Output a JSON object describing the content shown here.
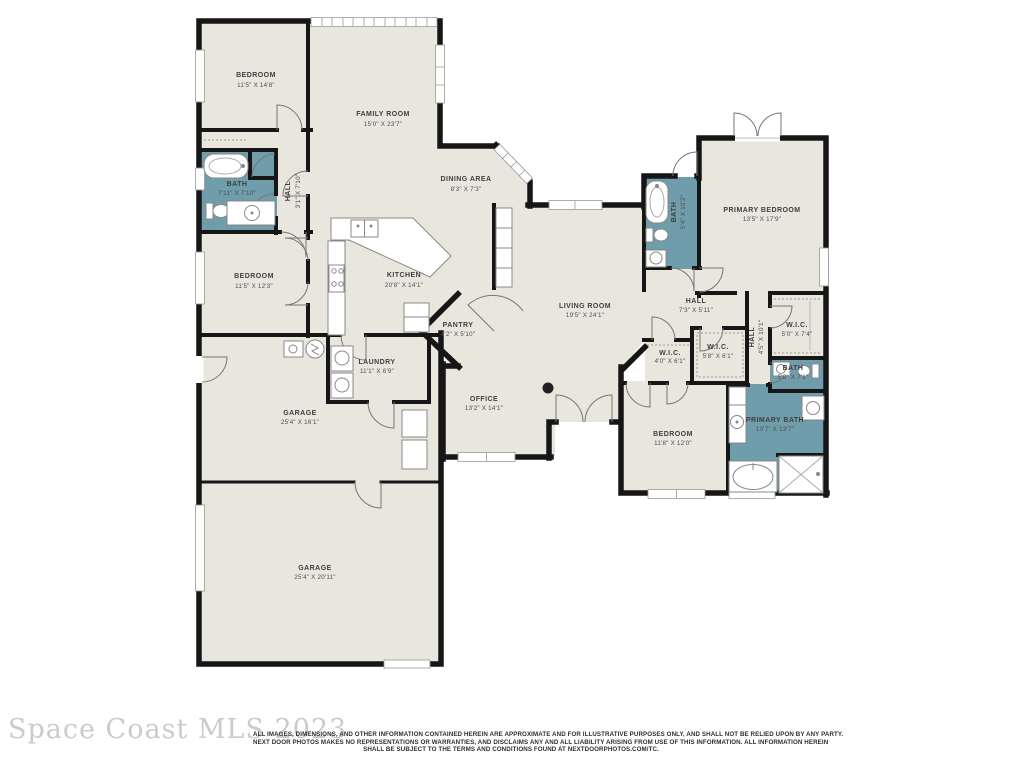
{
  "watermark": "Space Coast MLS 2023",
  "disclaimer": {
    "line1": "ALL IMAGES, DIMENSIONS, AND OTHER INFORMATION CONTAINED HEREIN ARE APPROXIMATE AND FOR ILLUSTRATIVE PURPOSES ONLY, AND SHALL NOT BE RELIED UPON BY ANY PARTY.",
    "line2": "NEXT DOOR PHOTOS MAKES NO REPRESENTATIONS OR WARRANTIES, AND DISCLAIMS ANY AND ALL LIABILITY ARISING FROM USE OF THIS INFORMATION. ALL INFORMATION HEREIN",
    "line3": "SHALL BE SUBJECT TO THE TERMS AND CONDITIONS FOUND AT NEXTDOORPHOTOS.COM/TC."
  },
  "colors": {
    "floor": "#e8e6dd",
    "bath_floor": "#6f9dab",
    "wall": "#161616",
    "fixture_line": "#888888",
    "label_text": "#3f3f3f",
    "watermark_text": "#cbcbcb"
  },
  "rooms": [
    {
      "id": "bedroom-top-left",
      "name": "BEDROOM",
      "dims": "11'5\" X 14'8\""
    },
    {
      "id": "family-room",
      "name": "FAMILY ROOM",
      "dims": "15'0\" X 23'7\""
    },
    {
      "id": "dining-area",
      "name": "DINING AREA",
      "dims": "8'3\" X 7'3\""
    },
    {
      "id": "bath-1",
      "name": "BATH",
      "dims": "7'11\" X 7'10\""
    },
    {
      "id": "hall-1",
      "name": "HALL",
      "dims": "3'1\" X 7'10\""
    },
    {
      "id": "bedroom-mid-left",
      "name": "BEDROOM",
      "dims": "11'5\" X 12'3\""
    },
    {
      "id": "kitchen",
      "name": "KITCHEN",
      "dims": "20'8\" X 14'1\""
    },
    {
      "id": "pantry",
      "name": "PANTRY",
      "dims": "4'2\" X 5'10\""
    },
    {
      "id": "laundry",
      "name": "LAUNDRY",
      "dims": "11'1\" X 6'9\""
    },
    {
      "id": "garage-1",
      "name": "GARAGE",
      "dims": "25'4\" X 16'1\""
    },
    {
      "id": "garage-2",
      "name": "GARAGE",
      "dims": "25'4\" X 20'11\""
    },
    {
      "id": "living-room",
      "name": "LIVING ROOM",
      "dims": "19'5\" X 24'1\""
    },
    {
      "id": "office",
      "name": "OFFICE",
      "dims": "13'2\" X 14'1\""
    },
    {
      "id": "bath-2",
      "name": "BATH",
      "dims": "5'4\" X 10'2\""
    },
    {
      "id": "primary-bedroom",
      "name": "PRIMARY BEDROOM",
      "dims": "13'5\" X 17'9\""
    },
    {
      "id": "hall-2",
      "name": "HALL",
      "dims": "7'3\" X 5'11\""
    },
    {
      "id": "wic-1",
      "name": "W.I.C.",
      "dims": "4'0\" X 6'1\""
    },
    {
      "id": "wic-2",
      "name": "W.I.C.",
      "dims": "5'8\" X 6'1\""
    },
    {
      "id": "hall-3",
      "name": "HALL",
      "dims": "4'5\" X 10'1\""
    },
    {
      "id": "wic-3",
      "name": "W.I.C.",
      "dims": "5'0\" X 7'4\""
    },
    {
      "id": "bath-3",
      "name": "BATH",
      "dims": "5'0\" X 7'1\""
    },
    {
      "id": "primary-bath",
      "name": "PRIMARY BATH",
      "dims": "10'7\" X 13'7\""
    },
    {
      "id": "bedroom-right",
      "name": "BEDROOM",
      "dims": "11'8\" X 12'0\""
    }
  ]
}
